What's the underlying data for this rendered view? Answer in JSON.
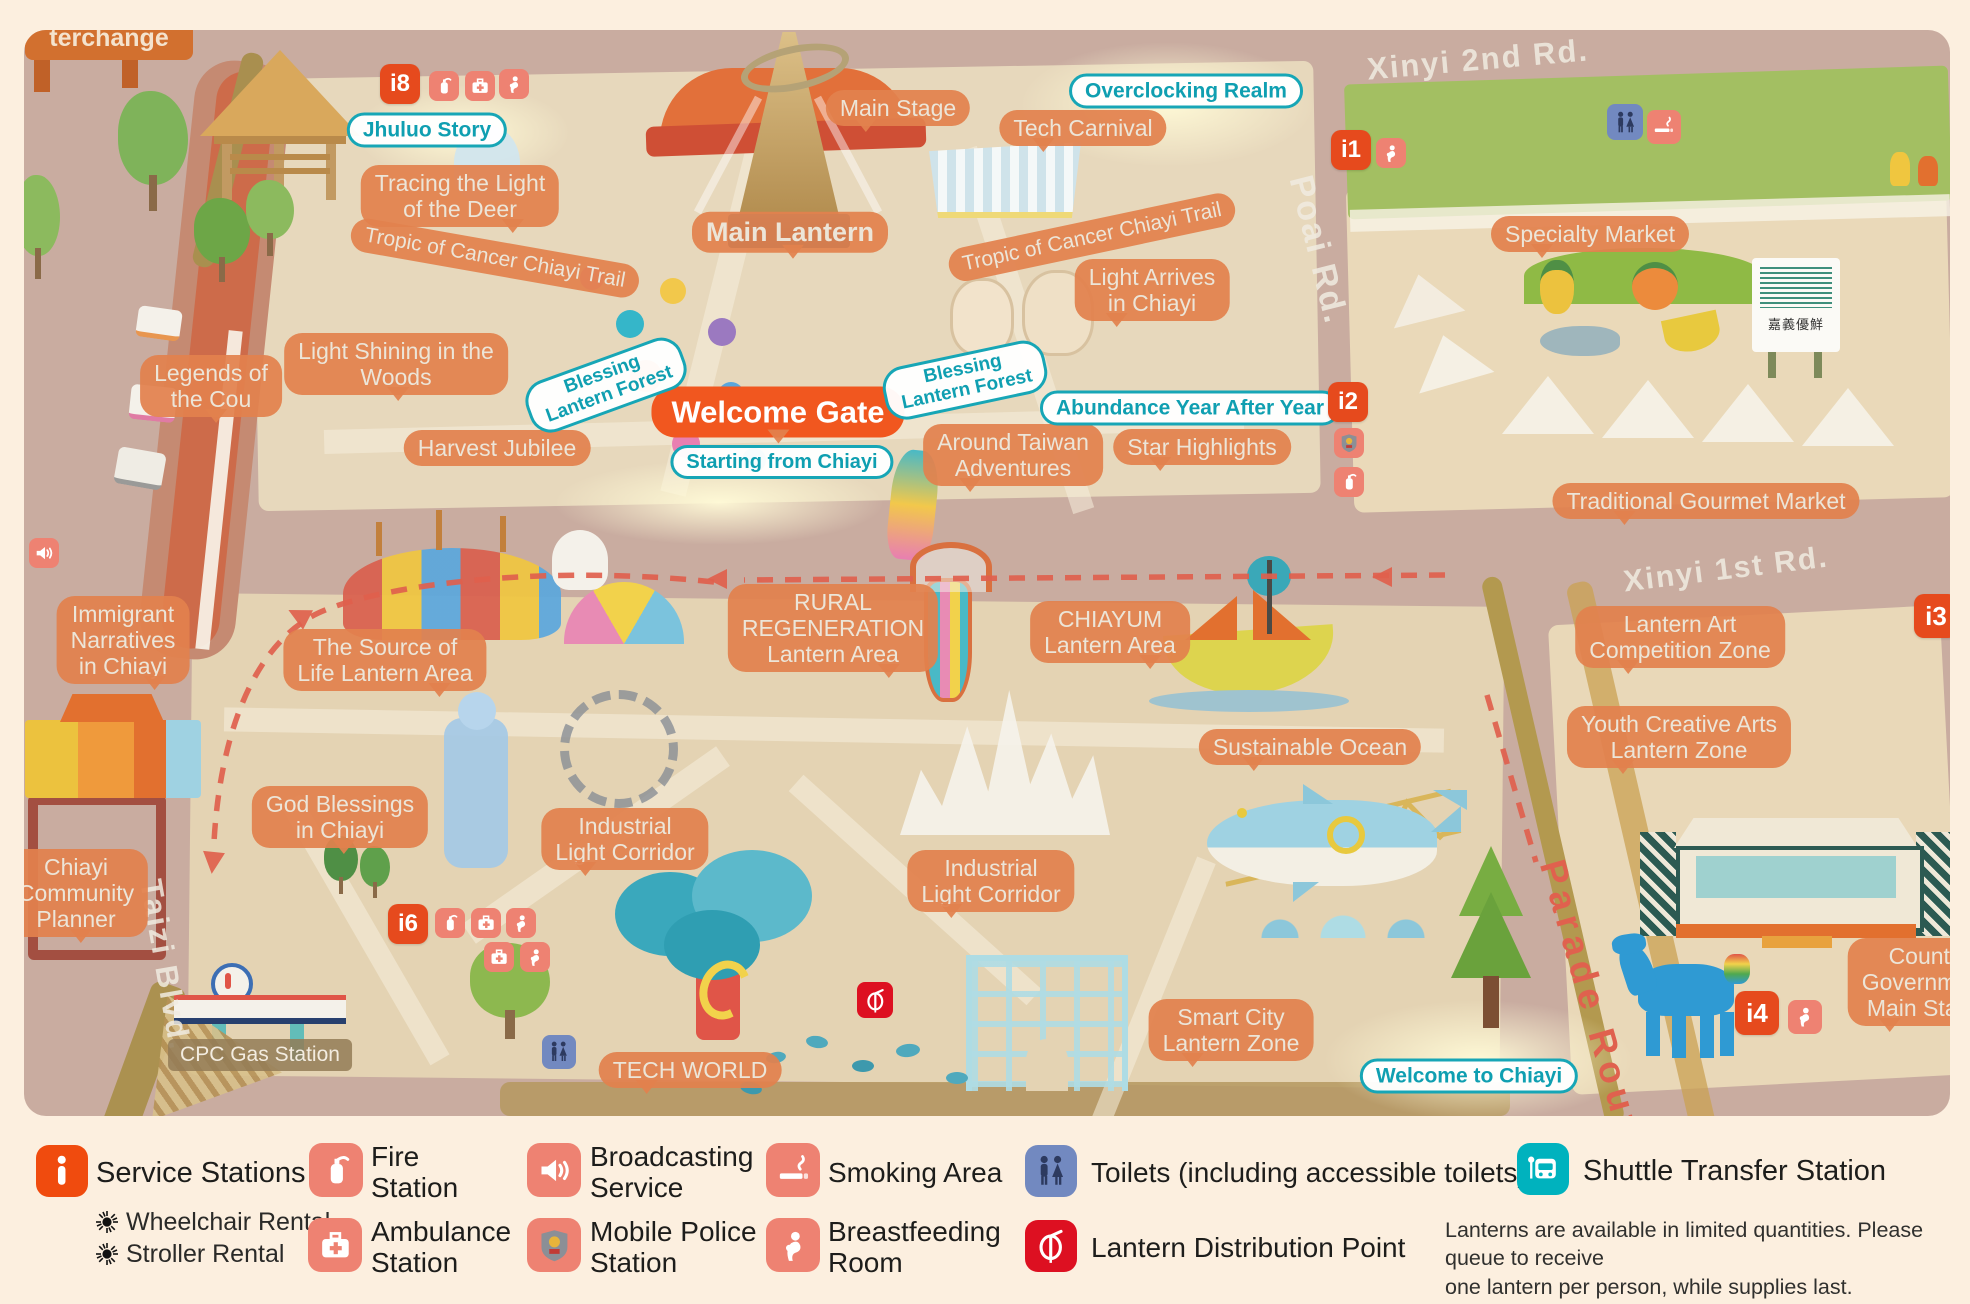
{
  "map": {
    "sign_fragment": "terchange",
    "roads": {
      "xinyi2nd": "Xinyi 2nd Rd.",
      "xinyi1st": "Xinyi 1st Rd.",
      "poai": "Poai Rd.",
      "taizi": "Taizi Blvd.",
      "parade": "Parade Route"
    },
    "stations": {
      "i1": "i1",
      "i2": "i2",
      "i3": "i3",
      "i4": "i4",
      "i6": "i6",
      "i8": "i8"
    },
    "labels": {
      "jhuluo_story": "Jhuluo Story",
      "tracing_light_deer": [
        "Tracing the Light",
        "of the Deer"
      ],
      "tropic_trail_left": "Tropic of Cancer Chiayi Trail",
      "tropic_trail_right": "Tropic of Cancer Chiayi Trail",
      "main_stage": "Main Stage",
      "main_lantern": "Main Lantern",
      "tech_carnival": "Tech Carnival",
      "overclocking_realm": "Overclocking Realm",
      "light_arrives": [
        "Light Arrives",
        "in Chiayi"
      ],
      "light_shining_woods": [
        "Light Shining in the",
        "Woods"
      ],
      "legends_cou": [
        "Legends of",
        "the Cou"
      ],
      "harvest_jubilee": "Harvest Jubilee",
      "blessing_forest_a": [
        "Blessing",
        "Lantern Forest"
      ],
      "blessing_forest_b": [
        "Blessing",
        "Lantern Forest"
      ],
      "welcome_gate": "Welcome Gate",
      "starting_chiayi": "Starting from Chiayi",
      "around_taiwan": [
        "Around Taiwan",
        "Adventures"
      ],
      "abundance_year": "Abundance Year After Year",
      "star_highlights": "Star Highlights",
      "specialty_market": "Specialty Market",
      "gourmet_market": "Traditional Gourmet Market",
      "market_sign": "嘉義優鮮",
      "rural_regeneration": [
        "RURAL",
        "REGENERATION",
        "Lantern  Area"
      ],
      "chiayum_area": [
        "CHIAYUM",
        "Lantern Area"
      ],
      "source_of_life": [
        "The Source of",
        "Life Lantern Area"
      ],
      "immigrant_narratives": [
        "Immigrant",
        "Narratives",
        "in Chiayi"
      ],
      "god_blessings": [
        "God Blessings",
        "in Chiayi"
      ],
      "community_planner": [
        "Chiayi",
        "Community",
        "Planner"
      ],
      "industrial_corridor_a": [
        "Industrial",
        "Light Corridor"
      ],
      "industrial_corridor_b": [
        "Industrial",
        "Light Corridor"
      ],
      "tech_world": "TECH WORLD",
      "cpc_station": "CPC Gas Station",
      "smart_city": [
        "Smart City",
        "Lantern Zone"
      ],
      "sustainable_ocean": "Sustainable Ocean",
      "welcome_to_chiayi": "Welcome to Chiayi",
      "lantern_art": [
        "Lantern Art",
        "Competition Zone"
      ],
      "youth_creative": [
        "Youth Creative Arts",
        "Lantern Zone"
      ],
      "county_stage": [
        "County Government",
        "Main Stage"
      ]
    }
  },
  "legend": {
    "service_stations": "Service Stations",
    "wheelchair_rental": "Wheelchair Rental",
    "stroller_rental": "Stroller Rental",
    "fire_station": [
      "Fire",
      "Station"
    ],
    "ambulance_station": [
      "Ambulance",
      "Station"
    ],
    "broadcasting_service": [
      "Broadcasting",
      "Service"
    ],
    "mobile_police": [
      "Mobile Police",
      "Station"
    ],
    "smoking_area": "Smoking Area",
    "breastfeeding_room": [
      "Breastfeeding",
      "Room"
    ],
    "toilets": "Toilets (including accessible toilets)",
    "lantern_distribution": "Lantern Distribution Point",
    "shuttle_transfer": "Shuttle Transfer Station",
    "note": [
      "Lanterns are available in limited quantities. Please queue to receive",
      "one lantern per person, while supplies last."
    ]
  },
  "colors": {
    "bubble_orange": "#e2814e",
    "accent_teal": "#15a6b6",
    "badge_red": "#e64a1d",
    "salmon": "#ee8272",
    "toilet_blue": "#7289c0",
    "lantern_red": "#dd1021",
    "shuttle_teal": "#00b2be"
  }
}
